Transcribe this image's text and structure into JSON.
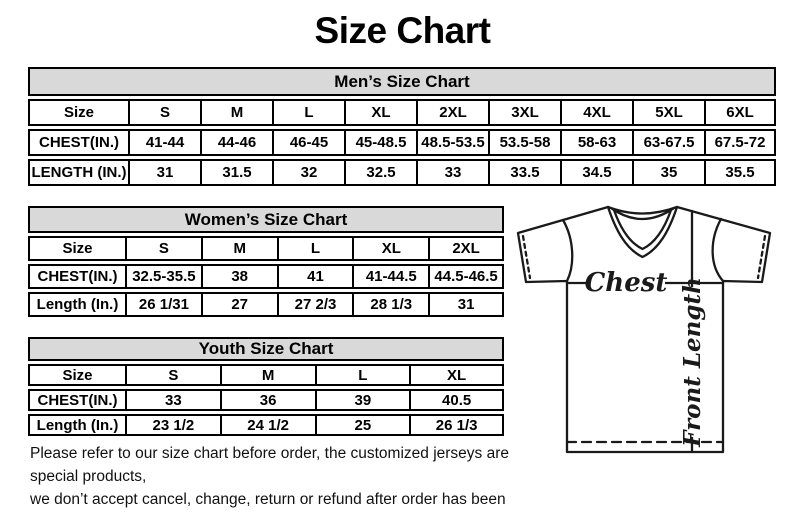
{
  "title": "Size Chart",
  "mens": {
    "title": "Men’s Size Chart",
    "labels": [
      "Size",
      "CHEST(IN.)",
      "LENGTH (IN.)"
    ],
    "sizes": [
      "S",
      "M",
      "L",
      "XL",
      "2XL",
      "3XL",
      "4XL",
      "5XL",
      "6XL"
    ],
    "chest": [
      "41-44",
      "44-46",
      "46-45",
      "45-48.5",
      "48.5-53.5",
      "53.5-58",
      "58-63",
      "63-67.5",
      "67.5-72"
    ],
    "length": [
      "31",
      "31.5",
      "32",
      "32.5",
      "33",
      "33.5",
      "34.5",
      "35",
      "35.5"
    ]
  },
  "womens": {
    "title": "Women’s Size Chart",
    "labels": [
      "Size",
      "CHEST(IN.)",
      "Length (In.)"
    ],
    "sizes": [
      "S",
      "M",
      "L",
      "XL",
      "2XL"
    ],
    "chest": [
      "32.5-35.5",
      "38",
      "41",
      "41-44.5",
      "44.5-46.5"
    ],
    "length": [
      "26 1/31",
      "27",
      "27 2/3",
      "28 1/3",
      "31"
    ]
  },
  "youth": {
    "title": "Youth Size Chart",
    "labels": [
      "Size",
      "CHEST(IN.)",
      "Length (In.)"
    ],
    "sizes": [
      "S",
      "M",
      "L",
      "XL"
    ],
    "chest": [
      "33",
      "36",
      "39",
      "40.5"
    ],
    "length": [
      "23 1/2",
      "24 1/2",
      "25",
      "26 1/3"
    ]
  },
  "shirt": {
    "chest_label": "Chest",
    "front_length_label": "Front Length"
  },
  "disclaimer": {
    "line1": "Please refer to our size chart before order, the customized jerseys are special products,",
    "line2": "we don’t accept cancel, change, return or refund after order has been placed!"
  },
  "colors": {
    "header_bg": "#d9d9d9",
    "border": "#000000",
    "text": "#000000",
    "background": "#ffffff"
  }
}
